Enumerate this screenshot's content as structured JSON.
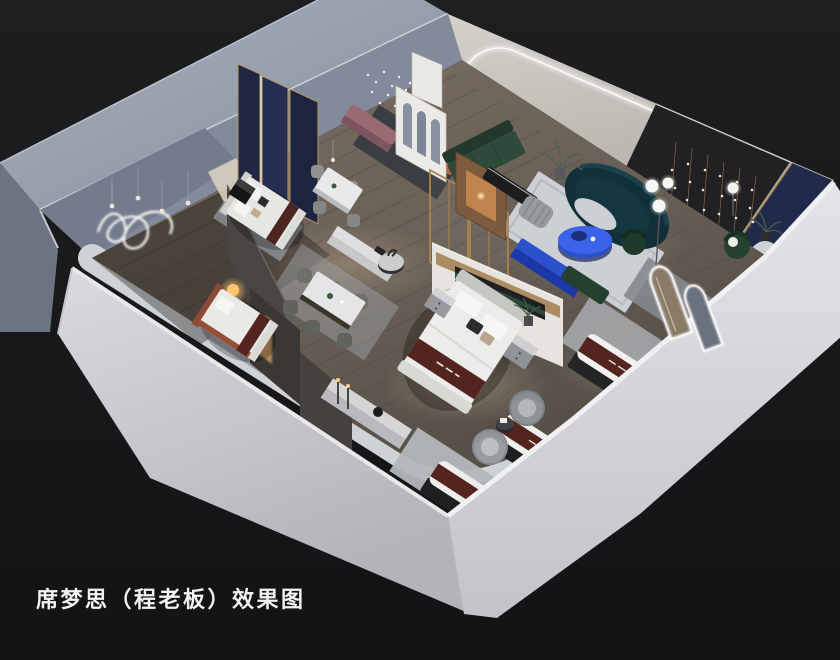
{
  "caption": {
    "text": "席梦思（程老板）效果图"
  },
  "scene": {
    "type": "3d-interior-showroom-rendering",
    "subject": "mattress-showroom-cutaway-birdseye",
    "background_color": "#17181a",
    "palette": {
      "outer_wall_left": "#c6c8cc",
      "outer_wall_right": "#d6d7da",
      "wall_top_band": "#99a1b0",
      "floor_wood": "#6a6057",
      "floor_slab": "#cfd2d5",
      "arch_wall_cream": "#c7c3bd",
      "led_white": "#ffffff",
      "accent_blue": "#2b50cc",
      "sofa_teal": "#11303a",
      "sofa_green": "#2e4a3a",
      "mattress_runner_maroon": "#54241f",
      "navy_panel": "#222a4c",
      "gold_trim": "#a8874f",
      "mauve_sofa": "#9a6a72",
      "rust_chair": "#b4643c",
      "lamp_warm": "#ffc66e"
    },
    "elements": [
      "outer-walls",
      "wood-floor",
      "arch-led-wall",
      "lightbox-window",
      "curtains",
      "crystal-chandeliers",
      "bead-curtain-wall",
      "navy-wall-panel",
      "neon-squiggle-art",
      "navy-gold-headboard-panels",
      "bed-double-1",
      "bed-double-2",
      "hero-bed",
      "marble-feature-wall",
      "dining-set-small",
      "dining-set-large",
      "mauve-bench",
      "rust-armchair",
      "round-coffee-tables",
      "green-l-sofa",
      "wood-display-screen",
      "tv-bench-black",
      "striped-pouf",
      "teal-curved-sofa",
      "blue-oval-table",
      "blue-bench",
      "green-accent-chairs",
      "globe-floor-lamps",
      "arch-mirror-panels",
      "display-mattresses",
      "wicker-swivel-chairs",
      "marble-console-candles",
      "nightstands",
      "area-rugs",
      "plants",
      "glow-ball-lamp"
    ]
  }
}
